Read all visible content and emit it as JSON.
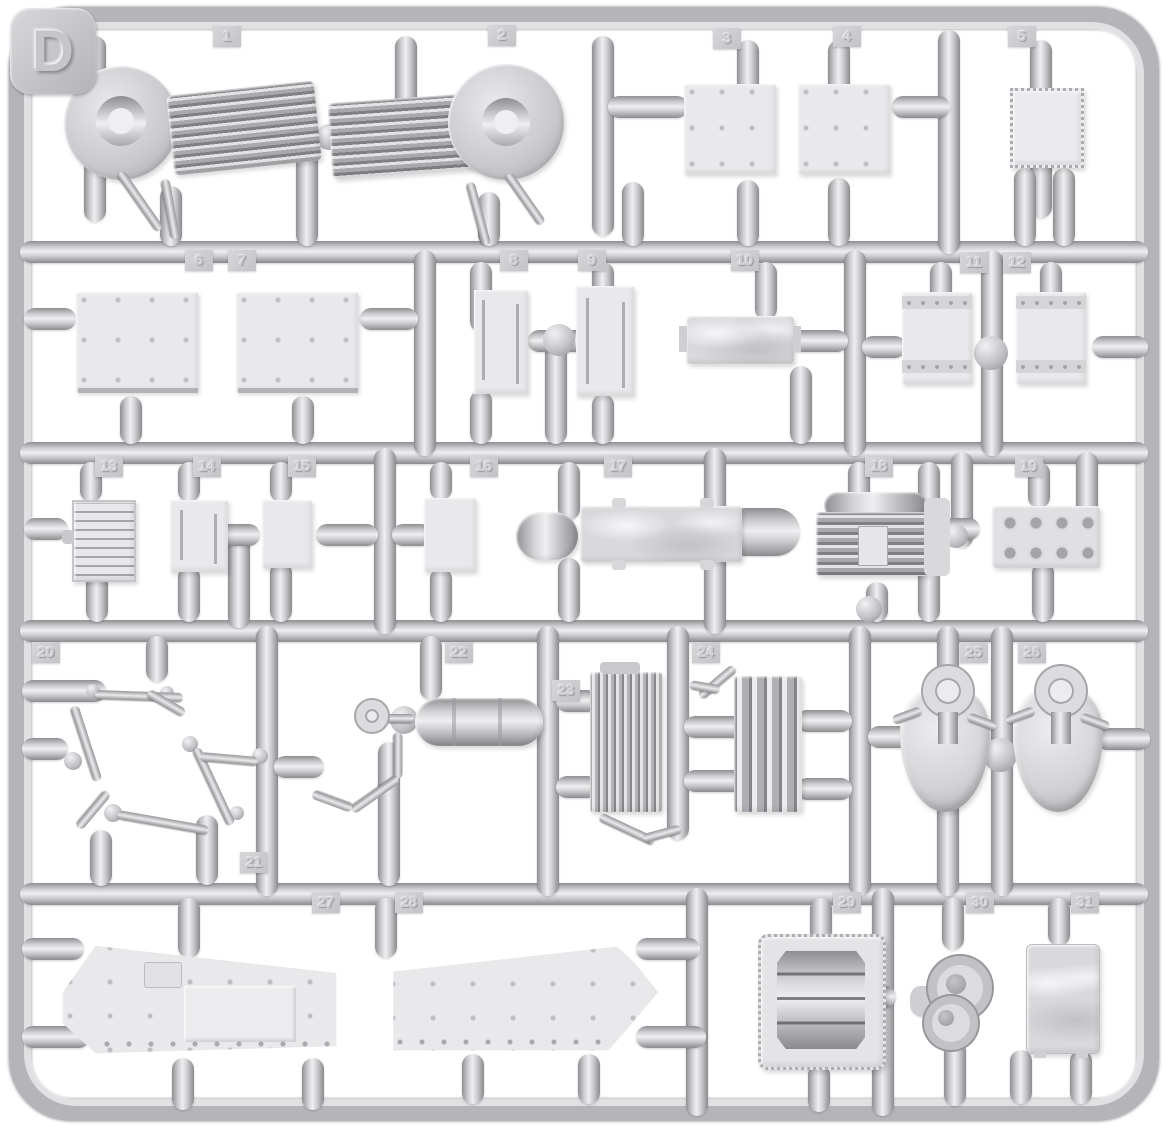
{
  "sprue": {
    "letter": "D",
    "plastic_color": "#c9c9cd",
    "runner_highlight": "#efeff1",
    "runner_shadow": "#8b8b8f",
    "part_face_color": "#e9e9ec",
    "tag_color": "#cfcfd3",
    "background_color": "#ffffff"
  },
  "parts": [
    {
      "number": "1",
      "name": "louvred-fan-housing"
    },
    {
      "number": "2",
      "name": "louvred-fan-housing"
    },
    {
      "number": "3",
      "name": "riveted-plate"
    },
    {
      "number": "4",
      "name": "riveted-plate"
    },
    {
      "number": "5",
      "name": "riveted-hatch"
    },
    {
      "number": "6",
      "name": "riveted-panel"
    },
    {
      "number": "7",
      "name": "riveted-panel"
    },
    {
      "number": "8",
      "name": "slotted-side-panel"
    },
    {
      "number": "9",
      "name": "slotted-side-panel"
    },
    {
      "number": "10",
      "name": "stowage-bin-lid"
    },
    {
      "number": "11",
      "name": "riveted-bracket"
    },
    {
      "number": "12",
      "name": "riveted-bracket"
    },
    {
      "number": "13",
      "name": "ribbed-radiator-core"
    },
    {
      "number": "14",
      "name": "slotted-plate"
    },
    {
      "number": "15",
      "name": "small-plate"
    },
    {
      "number": "16",
      "name": "small-plate"
    },
    {
      "number": "17",
      "name": "cylindrical-tank"
    },
    {
      "number": "18",
      "name": "finned-heater"
    },
    {
      "number": "19",
      "name": "drilled-valve-plate"
    },
    {
      "number": "20",
      "name": "linkage-rods"
    },
    {
      "number": "21",
      "name": "linkage-rods"
    },
    {
      "number": "22",
      "name": "crank-handle-tank"
    },
    {
      "number": "23",
      "name": "finned-oil-cooler"
    },
    {
      "number": "24",
      "name": "finned-oil-cooler"
    },
    {
      "number": "25",
      "name": "fan-drive-cover"
    },
    {
      "number": "26",
      "name": "fan-drive-cover"
    },
    {
      "number": "27",
      "name": "hull-side-panel"
    },
    {
      "number": "28",
      "name": "hull-side-panel"
    },
    {
      "number": "29",
      "name": "oil-pan"
    },
    {
      "number": "30",
      "name": "pump-housing"
    },
    {
      "number": "31",
      "name": "stowage-box"
    }
  ]
}
